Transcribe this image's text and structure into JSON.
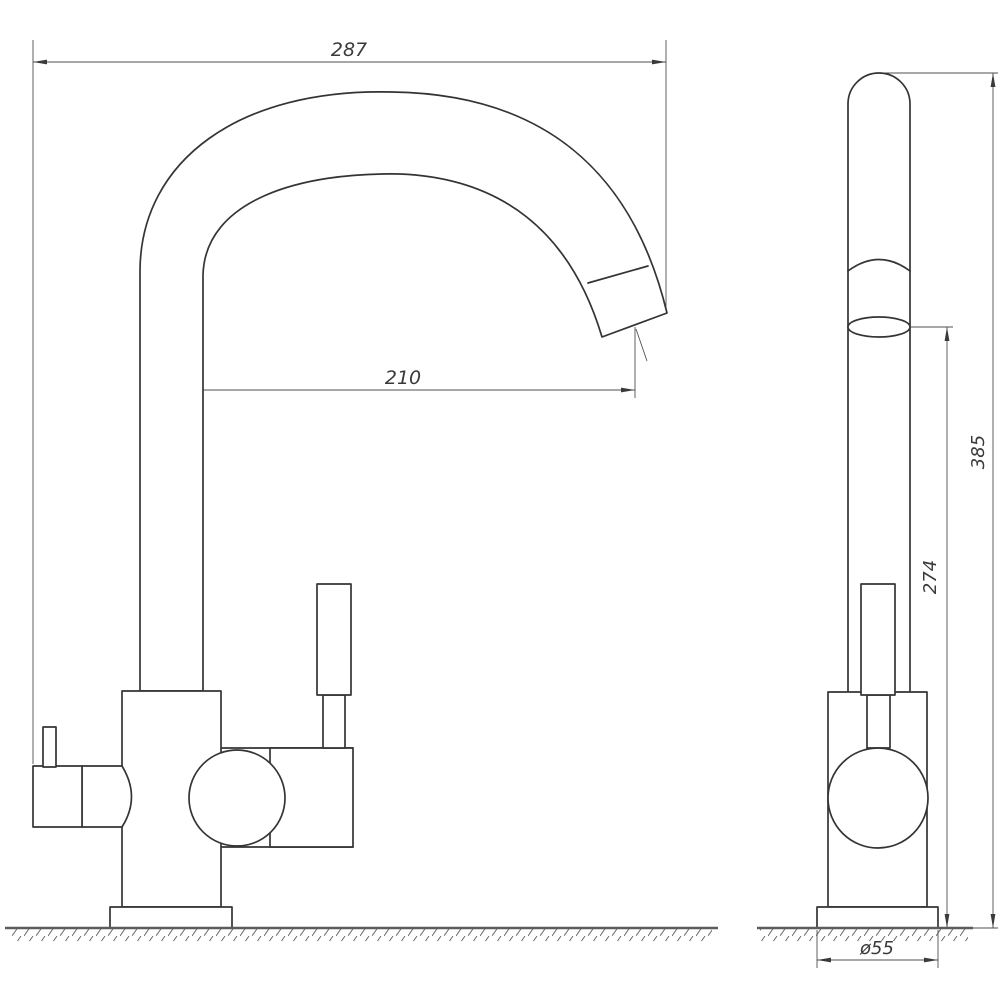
{
  "drawing": {
    "type": "technical-drawing",
    "subject": "kitchen faucet two-view dimension drawing",
    "background_color": "#ffffff",
    "object_line_color": "#343434",
    "dimension_line_color": "#4f4f4f",
    "dimensions": {
      "overall_width": "287",
      "spout_reach": "210",
      "overall_height": "385",
      "spout_pivot_height": "274",
      "base_diameter": "ø55"
    }
  }
}
